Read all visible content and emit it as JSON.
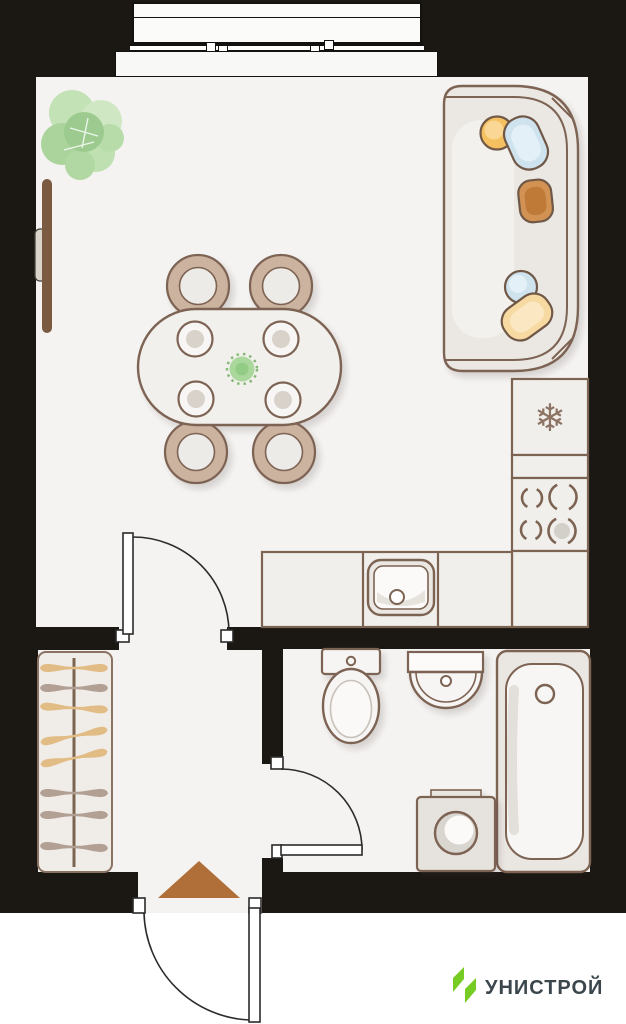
{
  "branding": {
    "logo_text": "УНИСТРОЙ",
    "logo_green": "#77cb25",
    "logo_text_color": "#3b464d"
  },
  "icons": {
    "fridge_snowflake": "❄"
  },
  "palette": {
    "wall_black": "#1b1813",
    "floor": "#f4f3f1",
    "outline_brown": "#7d6352",
    "furniture_fill": "#f1efec",
    "chair_tan": "#cbb3a0",
    "hanger_tan": "#e2bc85",
    "hanger_taupe": "#b3a094",
    "pillow_orange": "#f5c05e",
    "pillow_blue": "#cfe3ef",
    "pillow_rust": "#cd8847",
    "pillow_yellow": "#f7d9a2",
    "plant_green": "#b7dbaa",
    "entrance_arrow": "#b06f38"
  },
  "legend_items": [
    "balcony-window",
    "houseplant",
    "tv",
    "dining-table",
    "chair",
    "sofa",
    "fridge",
    "stove",
    "kitchen-counter",
    "kitchen-sink",
    "wardrobe-hangers",
    "toilet",
    "washbasin",
    "bathtub",
    "washing-machine",
    "interior-door",
    "entrance-door",
    "entrance-arrow"
  ]
}
